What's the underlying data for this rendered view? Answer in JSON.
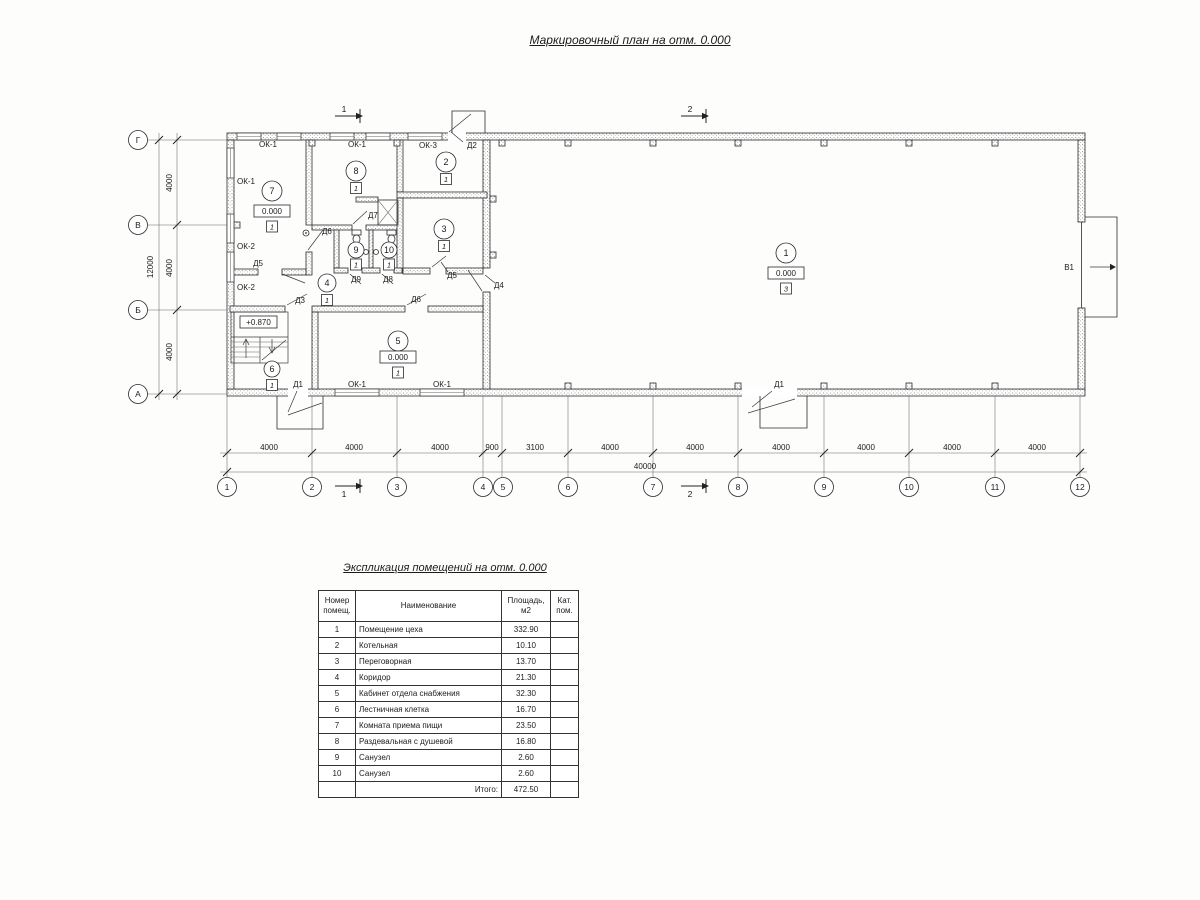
{
  "titles": {
    "plan": "Маркировочный план на отм. 0.000",
    "table": "Экспликация помещений на отм. 0.000"
  },
  "axes": {
    "cols": [
      "1",
      "2",
      "3",
      "4",
      "5",
      "6",
      "7",
      "8",
      "9",
      "10",
      "11",
      "12"
    ],
    "rows": [
      "Г",
      "В",
      "Б",
      "А"
    ]
  },
  "dims": {
    "bottom": [
      "4000",
      "4000",
      "4000",
      "900",
      "3100",
      "4000",
      "4000",
      "4000",
      "4000",
      "4000",
      "4000"
    ],
    "bottom_total": "40000",
    "left": [
      "4000",
      "4000",
      "4000"
    ],
    "left_total": "12000"
  },
  "sections": {
    "s1": "1",
    "s2": "2"
  },
  "rooms": {
    "r1": {
      "num": "1",
      "elev": "0.000",
      "floor": "3"
    },
    "r2": {
      "num": "2",
      "floor": "1"
    },
    "r3": {
      "num": "3",
      "floor": "1"
    },
    "r4": {
      "num": "4",
      "floor": "1"
    },
    "r5": {
      "num": "5",
      "elev": "0.000",
      "floor": "1"
    },
    "r6": {
      "num": "6",
      "floor": "1",
      "landing_elev": "+0.870"
    },
    "r7": {
      "num": "7",
      "elev": "0.000",
      "floor": "1"
    },
    "r8": {
      "num": "8",
      "floor": "1"
    },
    "r9": {
      "num": "9",
      "floor": "1"
    },
    "r10": {
      "num": "10",
      "floor": "1"
    }
  },
  "openings": {
    "d1": "Д1",
    "d2": "Д2",
    "d3": "Д3",
    "d4": "Д4",
    "d5": "Д5",
    "d6": "Д6",
    "d7": "Д7",
    "d8": "Д8",
    "d9": "Д9",
    "ok1": "ОК-1",
    "ok2": "ОК-2",
    "ok3": "ОК-3",
    "v1": "В1"
  },
  "schedule": {
    "headers": {
      "num_l1": "Номер",
      "num_l2": "помещ.",
      "name": "Наименование",
      "area_l1": "Площадь,",
      "area_l2": "м2",
      "cat_l1": "Кат.",
      "cat_l2": "пом."
    },
    "rows": [
      {
        "num": "1",
        "name": "Помещение цеха",
        "area": "332.90"
      },
      {
        "num": "2",
        "name": "Котельная",
        "area": "10.10"
      },
      {
        "num": "3",
        "name": "Переговорная",
        "area": "13.70"
      },
      {
        "num": "4",
        "name": "Коридор",
        "area": "21.30"
      },
      {
        "num": "5",
        "name": "Кабинет отдела снабжения",
        "area": "32.30"
      },
      {
        "num": "6",
        "name": "Лестничная клетка",
        "area": "16.70"
      },
      {
        "num": "7",
        "name": "Комната приема пищи",
        "area": "23.50"
      },
      {
        "num": "8",
        "name": "Раздевальная с душевой",
        "area": "16.80"
      },
      {
        "num": "9",
        "name": "Санузел",
        "area": "2.60"
      },
      {
        "num": "10",
        "name": "Санузел",
        "area": "2.60"
      }
    ],
    "total_label": "Итого:",
    "total_value": "472.50"
  }
}
